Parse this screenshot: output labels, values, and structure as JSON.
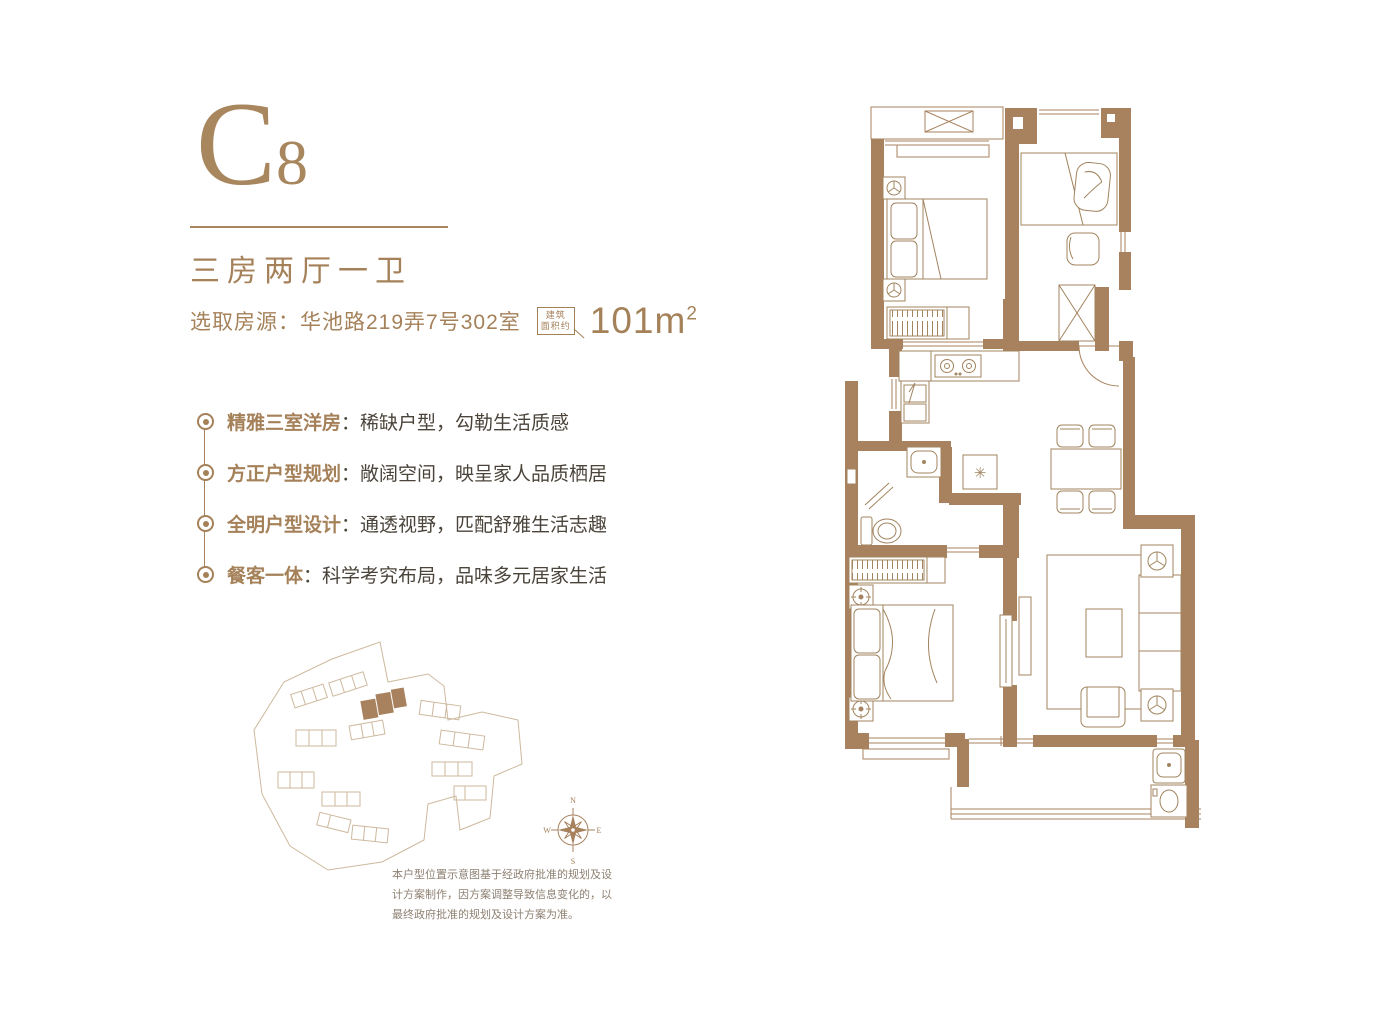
{
  "colors": {
    "accent_brown": "#a8825e",
    "label_brown": "#a5815a",
    "text_dark": "#4b443b",
    "site_outline": "#cdb99e",
    "muted_gray": "#8e8173"
  },
  "header": {
    "unit_code_main": "C",
    "unit_code_sub": "8",
    "unit_type": "三房两厅一卫",
    "source": "选取房源：华池路219弄7号302室",
    "badge_line1": "建筑",
    "badge_line2": "面积约",
    "area": "101m",
    "area_sup": "2"
  },
  "features": [
    {
      "label": "精雅三室洋房",
      "desc": "：稀缺户型，勾勒生活质感"
    },
    {
      "label": "方正户型规划",
      "desc": "：敞阔空间，映呈家人品质栖居"
    },
    {
      "label": "全明户型设计",
      "desc": "：通透视野，匹配舒雅生活志趣"
    },
    {
      "label": "餐客一体",
      "desc": "：科学考究布局，品味多元居家生活"
    }
  ],
  "compass": {
    "n": "N",
    "e": "E",
    "s": "S",
    "w": "W"
  },
  "floor_plan": {
    "fridge_symbol": "✳"
  },
  "disclaimer": "本户型位置示意图基于经政府批准的规划及设计方案制作，因方案调整导致信息变化的，以最终政府批准的规划及设计方案为准。"
}
